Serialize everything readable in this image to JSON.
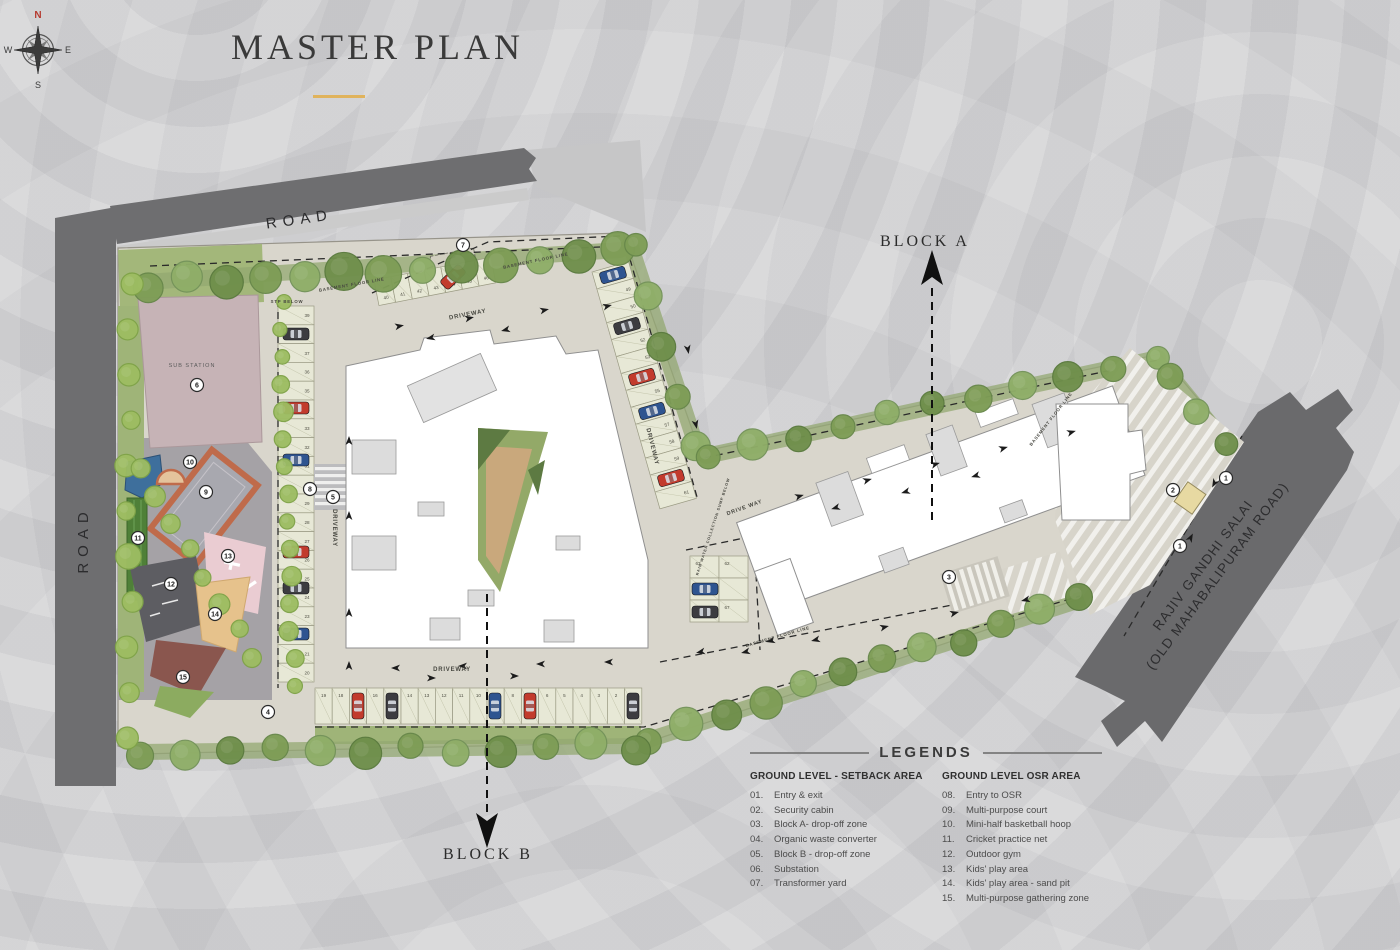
{
  "title": "MASTER PLAN",
  "roads": {
    "top": "ROAD",
    "left": "ROAD",
    "right_line1": "RAJIV GANDHI SALAI",
    "right_line2": "(OLD MAHABALIPURAM ROAD)"
  },
  "block_a_label": "BLOCK A",
  "block_b_label": "BLOCK B",
  "plan_texts": {
    "substation": "SUB STATION",
    "driveway": "DRIVEWAY",
    "driveway_spaced": "DRIVE WAY",
    "basement_floor_line": "BASEMENT FLOOR LINE",
    "stp_below": "STP BELOW",
    "rain_water": "RAIN WATER COLLECTION SUMP BELOW"
  },
  "legend": {
    "heading": "LEGENDS",
    "columns": [
      {
        "title": "GROUND LEVEL - SETBACK AREA",
        "items": [
          [
            "01.",
            "Entry & exit"
          ],
          [
            "02.",
            "Security cabin"
          ],
          [
            "03.",
            "Block A- drop-off zone"
          ],
          [
            "04.",
            "Organic waste converter"
          ],
          [
            "05.",
            "Block B - drop-off zone"
          ],
          [
            "06.",
            "Substation"
          ],
          [
            "07.",
            "Transformer yard"
          ]
        ]
      },
      {
        "title": "GROUND LEVEL OSR AREA",
        "items": [
          [
            "08.",
            "Entry to OSR"
          ],
          [
            "09.",
            "Multi-purpose court"
          ],
          [
            "10.",
            "Mini-half basketball hoop"
          ],
          [
            "11.",
            "Cricket practice net"
          ],
          [
            "12.",
            "Outdoor gym"
          ],
          [
            "13.",
            "Kids' play area"
          ],
          [
            "14.",
            "Kids' play area - sand pit"
          ],
          [
            "15.",
            "Multi-purpose gathering zone"
          ]
        ]
      }
    ]
  },
  "compass": {
    "n": "N",
    "e": "E",
    "s": "S",
    "w": "W"
  },
  "markers": [
    {
      "n": "1",
      "x": 1226,
      "y": 478
    },
    {
      "n": "1",
      "x": 1180,
      "y": 546
    },
    {
      "n": "2",
      "x": 1173,
      "y": 490
    },
    {
      "n": "3",
      "x": 949,
      "y": 577
    },
    {
      "n": "4",
      "x": 268,
      "y": 712
    },
    {
      "n": "5",
      "x": 333,
      "y": 497
    },
    {
      "n": "6",
      "x": 197,
      "y": 385
    },
    {
      "n": "7",
      "x": 463,
      "y": 245
    },
    {
      "n": "8",
      "x": 310,
      "y": 489
    },
    {
      "n": "9",
      "x": 206,
      "y": 492
    },
    {
      "n": "10",
      "x": 190,
      "y": 462
    },
    {
      "n": "11",
      "x": 138,
      "y": 538
    },
    {
      "n": "12",
      "x": 171,
      "y": 584
    },
    {
      "n": "13",
      "x": 228,
      "y": 556
    },
    {
      "n": "14",
      "x": 215,
      "y": 614
    },
    {
      "n": "15",
      "x": 183,
      "y": 677
    }
  ],
  "parking": {
    "left_column": [
      "39",
      "38",
      "37",
      "36",
      "35",
      "34",
      "33",
      "32",
      "31",
      "30",
      "29",
      "28",
      "27",
      "26",
      "25",
      "24",
      "23",
      "22",
      "21",
      "20"
    ],
    "bottom_row": [
      "19",
      "18",
      "17",
      "16",
      "15",
      "14",
      "13",
      "12",
      "11",
      "10",
      "9",
      "8",
      "7",
      "6",
      "5",
      "4",
      "3",
      "2",
      "1"
    ],
    "right_column": [
      "48",
      "49",
      "50",
      "51",
      "52",
      "53",
      "54",
      "55",
      "56",
      "57",
      "58",
      "59",
      "60",
      "61"
    ],
    "top_row": [
      "40",
      "41",
      "42",
      "43",
      "44",
      "45",
      "46"
    ],
    "bay": [
      "63",
      "62",
      "65",
      "67"
    ]
  },
  "colors": {
    "accent_gold": "#e0b35c",
    "road_gray": "#6e6e70",
    "site_paving": "#d9d6cc",
    "plaza_gray": "#a5a2a6",
    "substation_mauve": "#c6b3b6",
    "court_border_orange": "#bf6b4b",
    "tree_green": "#7e9d56",
    "palm_green": "#9dbd62",
    "compass_north_red": "#b53a30"
  }
}
